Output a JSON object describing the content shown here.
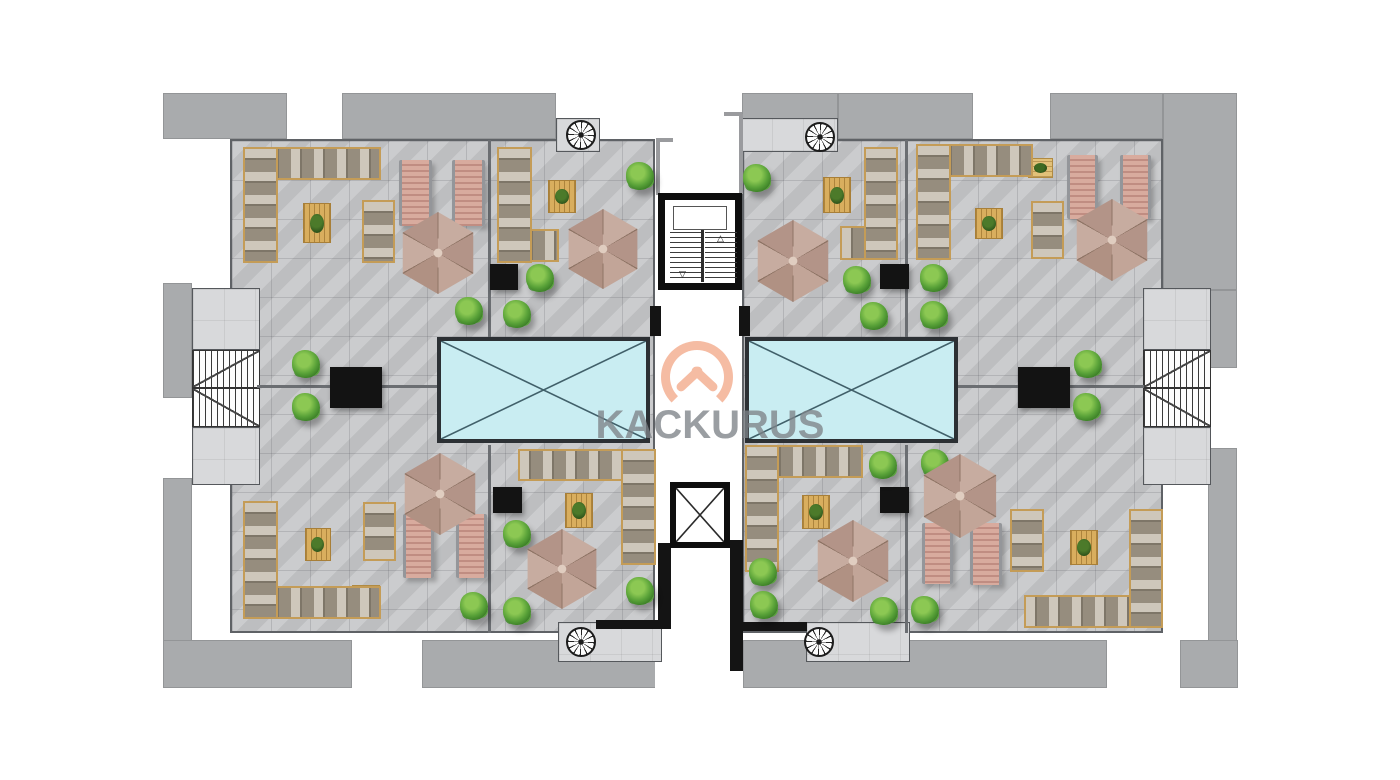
{
  "watermark": {
    "text": "KACKURUS",
    "logo_color": "#f5bca3",
    "text_color": "#7e8388"
  },
  "icons": {
    "stair_up_arrow": "△",
    "stair_down_arrow": "▽"
  },
  "colors": {
    "background": "#ffffff",
    "building_mass": "#a9abad",
    "terrace_tile": "#c7c8ca",
    "room_light": "#d8d9db",
    "pool_water": "#c9edf2",
    "pool_frame": "#2c3034",
    "wood": "#d9ae5e",
    "umbrella": "#c2a598",
    "plant": "#58a138",
    "lounger_pink": "#d8ab9e",
    "sofa": "#968d7e",
    "wall_dark": "#141414"
  },
  "plan": {
    "names": {
      "umbrella": "patio-umbrella",
      "plant": "potted-plant",
      "mat": "wood-rug",
      "deck": "wood-deck",
      "lounger": "sun-lounger",
      "table-black": "black-table",
      "sofa-h": "sofa-section",
      "sofa-v": "sofa-section",
      "spiral": "spiral-staircase-icon"
    },
    "items": {
      "mat": [
        [
          303,
          203,
          28,
          40
        ],
        [
          548,
          180,
          28,
          33
        ],
        [
          823,
          177,
          28,
          36
        ],
        [
          975,
          208,
          28,
          31
        ],
        [
          305,
          528,
          26,
          33
        ],
        [
          565,
          493,
          28,
          35
        ],
        [
          802,
          495,
          28,
          34
        ],
        [
          1070,
          530,
          28,
          35
        ]
      ],
      "deck": [
        [
          353,
          147,
          28,
          30
        ],
        [
          922,
          146,
          27,
          28
        ],
        [
          1028,
          158,
          25,
          20
        ],
        [
          352,
          585,
          28,
          32
        ],
        [
          518,
          450,
          26,
          30
        ],
        [
          802,
          450,
          28,
          27
        ],
        [
          1024,
          596,
          28,
          31
        ]
      ],
      "lounger": [
        [
          399,
          160,
          33,
          66
        ],
        [
          452,
          160,
          33,
          66
        ],
        [
          1067,
          155,
          31,
          64
        ],
        [
          1120,
          155,
          31,
          64
        ],
        [
          403,
          514,
          31,
          64
        ],
        [
          456,
          514,
          31,
          64
        ],
        [
          922,
          523,
          31,
          61
        ],
        [
          970,
          523,
          32,
          62
        ]
      ],
      "table-black": [
        [
          490,
          264,
          28,
          26
        ],
        [
          880,
          264,
          29,
          25
        ],
        [
          330,
          367,
          52,
          41
        ],
        [
          1018,
          367,
          52,
          41
        ],
        [
          493,
          487,
          29,
          26
        ],
        [
          880,
          487,
          29,
          26
        ]
      ],
      "sofa-h": [
        [
          243,
          147,
          138,
          33
        ],
        [
          497,
          229,
          62,
          33
        ],
        [
          840,
          226,
          58,
          34
        ],
        [
          916,
          144,
          117,
          33
        ],
        [
          243,
          586,
          138,
          33
        ],
        [
          518,
          449,
          138,
          32
        ],
        [
          745,
          445,
          118,
          33
        ],
        [
          1024,
          595,
          139,
          33
        ]
      ],
      "sofa-v": [
        [
          243,
          147,
          35,
          116
        ],
        [
          497,
          147,
          35,
          116
        ],
        [
          864,
          147,
          34,
          113
        ],
        [
          916,
          144,
          35,
          116
        ],
        [
          243,
          501,
          35,
          118
        ],
        [
          621,
          449,
          35,
          116
        ],
        [
          745,
          445,
          34,
          127
        ],
        [
          1129,
          509,
          34,
          119
        ],
        [
          362,
          200,
          33,
          63
        ],
        [
          1031,
          201,
          33,
          58
        ],
        [
          363,
          502,
          33,
          59
        ],
        [
          1010,
          509,
          34,
          63
        ]
      ],
      "plant": [
        [
          455,
          297,
          28,
          28
        ],
        [
          626,
          162,
          28,
          28
        ],
        [
          526,
          264,
          28,
          28
        ],
        [
          503,
          300,
          28,
          28
        ],
        [
          743,
          164,
          28,
          28
        ],
        [
          843,
          266,
          28,
          28
        ],
        [
          860,
          302,
          28,
          28
        ],
        [
          920,
          264,
          28,
          28
        ],
        [
          920,
          301,
          28,
          28
        ],
        [
          292,
          350,
          28,
          28
        ],
        [
          292,
          393,
          28,
          28
        ],
        [
          1074,
          350,
          28,
          28
        ],
        [
          1073,
          393,
          28,
          28
        ],
        [
          460,
          592,
          28,
          28
        ],
        [
          503,
          520,
          28,
          28
        ],
        [
          503,
          597,
          28,
          28
        ],
        [
          626,
          577,
          28,
          28
        ],
        [
          749,
          558,
          28,
          28
        ],
        [
          750,
          591,
          28,
          28
        ],
        [
          870,
          597,
          28,
          28
        ],
        [
          869,
          451,
          28,
          28
        ],
        [
          921,
          449,
          28,
          28
        ],
        [
          911,
          596,
          28,
          28
        ]
      ],
      "spiral": [
        [
          566,
          120,
          30,
          30
        ],
        [
          805,
          122,
          30,
          30
        ],
        [
          566,
          627,
          30,
          30
        ],
        [
          804,
          627,
          30,
          30
        ]
      ],
      "umbrella": [
        [
          397,
          212,
          82,
          82
        ],
        [
          563,
          209,
          80,
          80
        ],
        [
          752,
          220,
          82,
          82
        ],
        [
          1071,
          199,
          82,
          82
        ],
        [
          399,
          453,
          82,
          82
        ],
        [
          522,
          529,
          80,
          80
        ],
        [
          812,
          520,
          82,
          82
        ],
        [
          918,
          454,
          84,
          84
        ]
      ]
    },
    "pools": [
      {
        "x": 437,
        "y": 337,
        "w": 213,
        "h": 106
      },
      {
        "x": 745,
        "y": 337,
        "w": 213,
        "h": 106
      }
    ]
  }
}
